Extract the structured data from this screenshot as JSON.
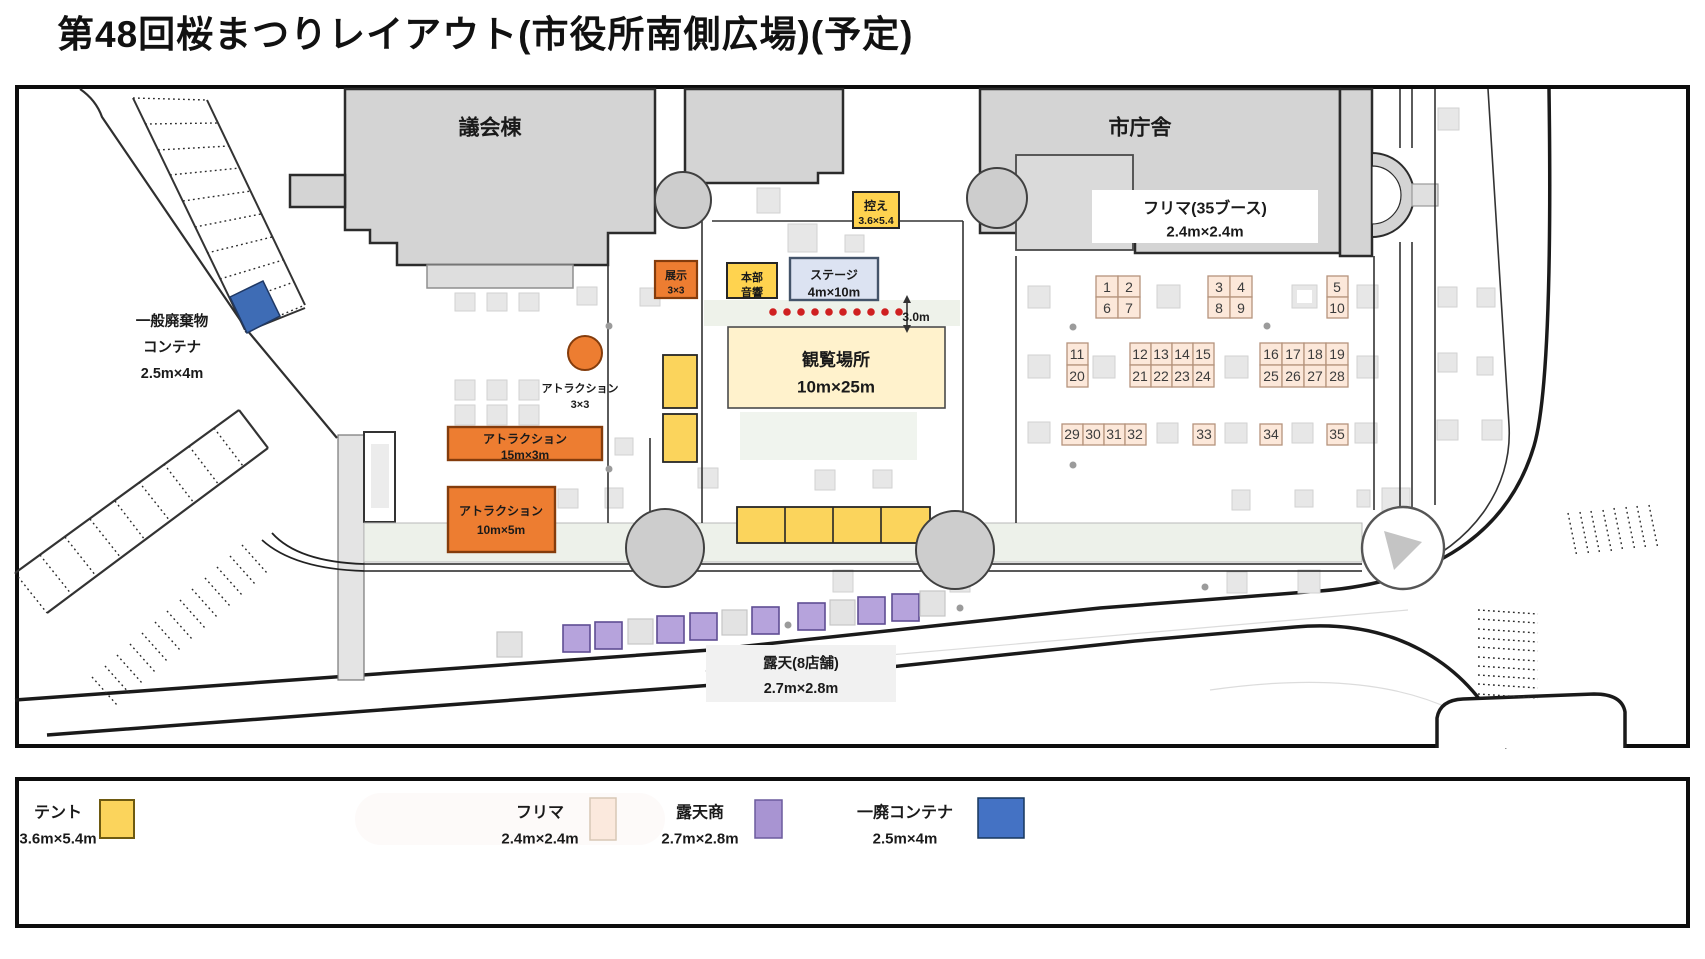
{
  "title": "第48回桜まつりレイアウト(市役所南側広場)(予定)",
  "map": {
    "buildings": {
      "assembly": "議会棟",
      "city_hall": "市庁舎"
    },
    "flea_area": {
      "label_line1": "フリマ(35ブース)",
      "label_line2": "2.4m×2.4m",
      "booth_numbers": [
        "1",
        "2",
        "3",
        "4",
        "5",
        "6",
        "7",
        "8",
        "9",
        "10",
        "11",
        "12",
        "13",
        "14",
        "15",
        "16",
        "17",
        "18",
        "19",
        "20",
        "21",
        "22",
        "23",
        "24",
        "25",
        "26",
        "27",
        "28",
        "29",
        "30",
        "31",
        "32",
        "33",
        "34",
        "35"
      ]
    },
    "waiting": {
      "line1": "控え",
      "line2": "3.6×5.4"
    },
    "exhibit": {
      "line1": "展示",
      "line2": "3×3"
    },
    "hq": {
      "line1": "本部",
      "line2": "音響"
    },
    "stage": {
      "line1": "ステージ",
      "line2": "4m×10m"
    },
    "viewing": {
      "line1": "観覧場所",
      "line2": "10m×25m"
    },
    "gap_label": "3.0m",
    "attraction_circle": {
      "line1": "アトラクション",
      "line2": "3×3"
    },
    "attraction_wide": {
      "line1": "アトラクション",
      "line2": "15m×3m"
    },
    "attraction_small": {
      "line1": "アトラクション",
      "line2": "10m×5m"
    },
    "waste": {
      "line1": "一般廃棄物",
      "line2": "コンテナ",
      "line3": "2.5m×4m"
    },
    "street_stalls": {
      "line1": "露天(8店舗)",
      "line2": "2.7m×2.8m"
    }
  },
  "legend": {
    "items": [
      {
        "label": "テント",
        "size": "3.6m×5.4m",
        "color": "#fbd45c"
      },
      {
        "label": "フリマ",
        "size": "2.4m×2.4m",
        "color": "#fbe9dd"
      },
      {
        "label": "露天商",
        "size": "2.7m×2.8m",
        "color": "#a894d2"
      },
      {
        "label": "一廃コンテナ",
        "size": "2.5m×4m",
        "color": "#4472c4"
      }
    ]
  },
  "colors": {
    "attraction": "#ed7d31",
    "tent_yellow": "#fbd45c",
    "stage_blue": "#dce3f2",
    "viewing_yellow": "#fff2cc",
    "container_blue": "#4472c4",
    "stall_purple": "#b6a3dc",
    "flea_peach": "#fce8da"
  }
}
